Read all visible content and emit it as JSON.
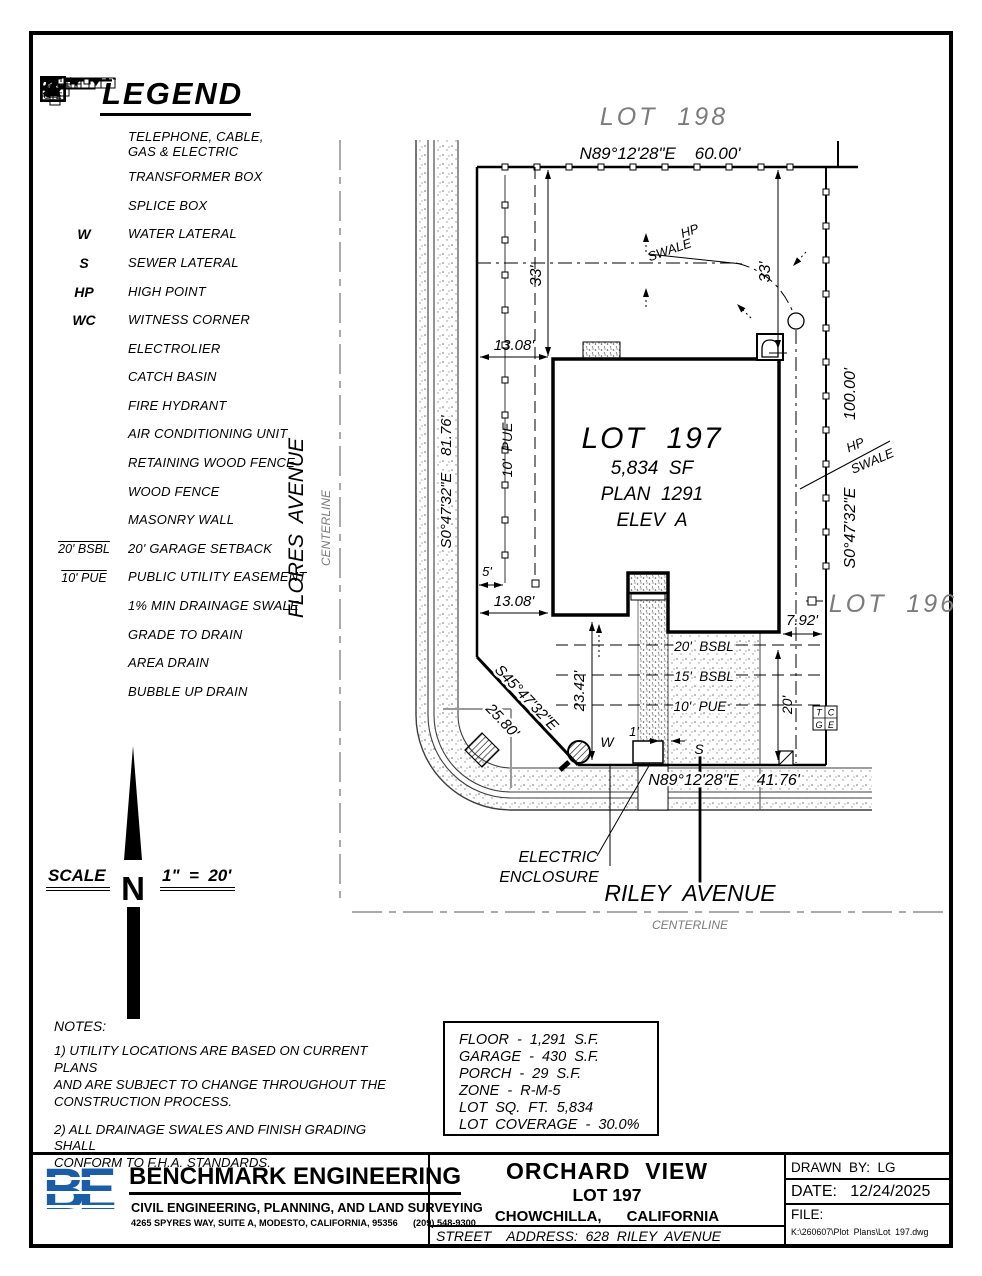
{
  "legend": {
    "title": "LEGEND",
    "items": [
      {
        "label": "TELEPHONE, CABLE,\nGAS & ELECTRIC"
      },
      {
        "label": "TRANSFORMER BOX"
      },
      {
        "label": "SPLICE BOX"
      },
      {
        "sym": "W",
        "label": "WATER LATERAL"
      },
      {
        "sym": "S",
        "label": "SEWER LATERAL"
      },
      {
        "sym": "HP",
        "label": "HIGH POINT"
      },
      {
        "sym": "WC",
        "label": "WITNESS CORNER"
      },
      {
        "label": "ELECTROLIER"
      },
      {
        "label": "CATCH BASIN"
      },
      {
        "label": "FIRE HYDRANT"
      },
      {
        "label": "AIR CONDITIONING UNIT"
      },
      {
        "label": "RETAINING WOOD FENCE"
      },
      {
        "label": "WOOD FENCE"
      },
      {
        "label": "MASONRY WALL"
      },
      {
        "sym": "20' BSBL",
        "label": "20' GARAGE SETBACK"
      },
      {
        "sym": "10' PUE",
        "label": "PUBLIC UTILITY EASEMENT"
      },
      {
        "label": "1% MIN DRAINAGE SWALE"
      },
      {
        "label": "GRADE TO DRAIN"
      },
      {
        "label": "AREA DRAIN"
      },
      {
        "label": "BUBBLE UP DRAIN"
      }
    ]
  },
  "drawing": {
    "lot_198": "LOT  198",
    "lot_196": "LOT  196",
    "north_boundary": "N89°12'28\"E    60.00'",
    "south_boundary": "N89°12'28\"E    41.76'",
    "west_boundary": "S0°47'32\"E    81.76'",
    "east_bearing": "S0°47'32\"E",
    "east_length": "100.00'",
    "diag_bearing": "S45°47'32\"E",
    "diag_length": "25.80'",
    "lot_title": "LOT  197",
    "lot_area": "5,834  SF",
    "lot_plan": "PLAN  1291",
    "lot_elev": "ELEV  A",
    "dim_33_left": "33'",
    "dim_33_right": "33'",
    "dim_1308_top": "13.08'",
    "dim_1308_bottom": "13.08'",
    "dim_5": "5'",
    "dim_2342": "23.42'",
    "dim_792": "7.92'",
    "dim_20": "20'",
    "dim_1": "1'",
    "pue_left": "10'  PUE",
    "bsbl_20": "20'  BSBL",
    "bsbl_15": "15'  BSBL",
    "pue_10": "10'  PUE",
    "hp_upper": "HP",
    "swale_upper": "SWALE",
    "hp_lower": "HP",
    "swale_lower": "SWALE",
    "water": "W",
    "sewer": "S",
    "tcge": {
      "t": "T",
      "c": "C",
      "g": "G",
      "e": "E"
    },
    "electric_line1": "ELECTRIC",
    "electric_line2": "ENCLOSURE",
    "flores": "FLORES  AVENUE",
    "flores_cl": "CENTERLINE",
    "riley": "RILEY  AVENUE",
    "riley_cl": "CENTERLINE"
  },
  "scale_block": {
    "label": "SCALE",
    "value": "1\"  =  20'",
    "north": "N"
  },
  "notes": {
    "title": "NOTES:",
    "n1": "1)  UTILITY  LOCATIONS  ARE  BASED  ON  CURRENT  PLANS\nAND  ARE  SUBJECT  TO  CHANGE  THROUGHOUT  THE\nCONSTRUCTION  PROCESS.",
    "n2": "2)  ALL  DRAINAGE  SWALES  AND  FINISH  GRADING  SHALL\nCONFORM  TO  F.H.A.  STANDARDS."
  },
  "site_info": {
    "rows": [
      "FLOOR  -  1,291  S.F.",
      "GARAGE  -  430  S.F.",
      "PORCH  -  29  S.F.",
      "ZONE  -  R-M-5",
      "LOT  SQ.  FT.  5,834",
      "LOT  COVERAGE  -  30.0%"
    ]
  },
  "title_block": {
    "logo": "BE",
    "company": "BENCHMARK ENGINEERING",
    "tagline": "CIVIL ENGINEERING, PLANNING, AND LAND SURVEYING",
    "address": "4265 SPYRES WAY, SUITE A, MODESTO, CALIFORNIA, 95356      (209) 548-9300",
    "project": "ORCHARD  VIEW",
    "lot": "LOT 197",
    "city": "CHOWCHILLA,      CALIFORNIA",
    "street_address": "STREET    ADDRESS:  628  RILEY  AVENUE",
    "drawn_by": "DRAWN  BY:  LG",
    "date": "DATE:   12/24/2025",
    "file_label": "FILE:",
    "file_path": "K:\\260607\\Plot  Plans\\Lot  197.dwg"
  }
}
